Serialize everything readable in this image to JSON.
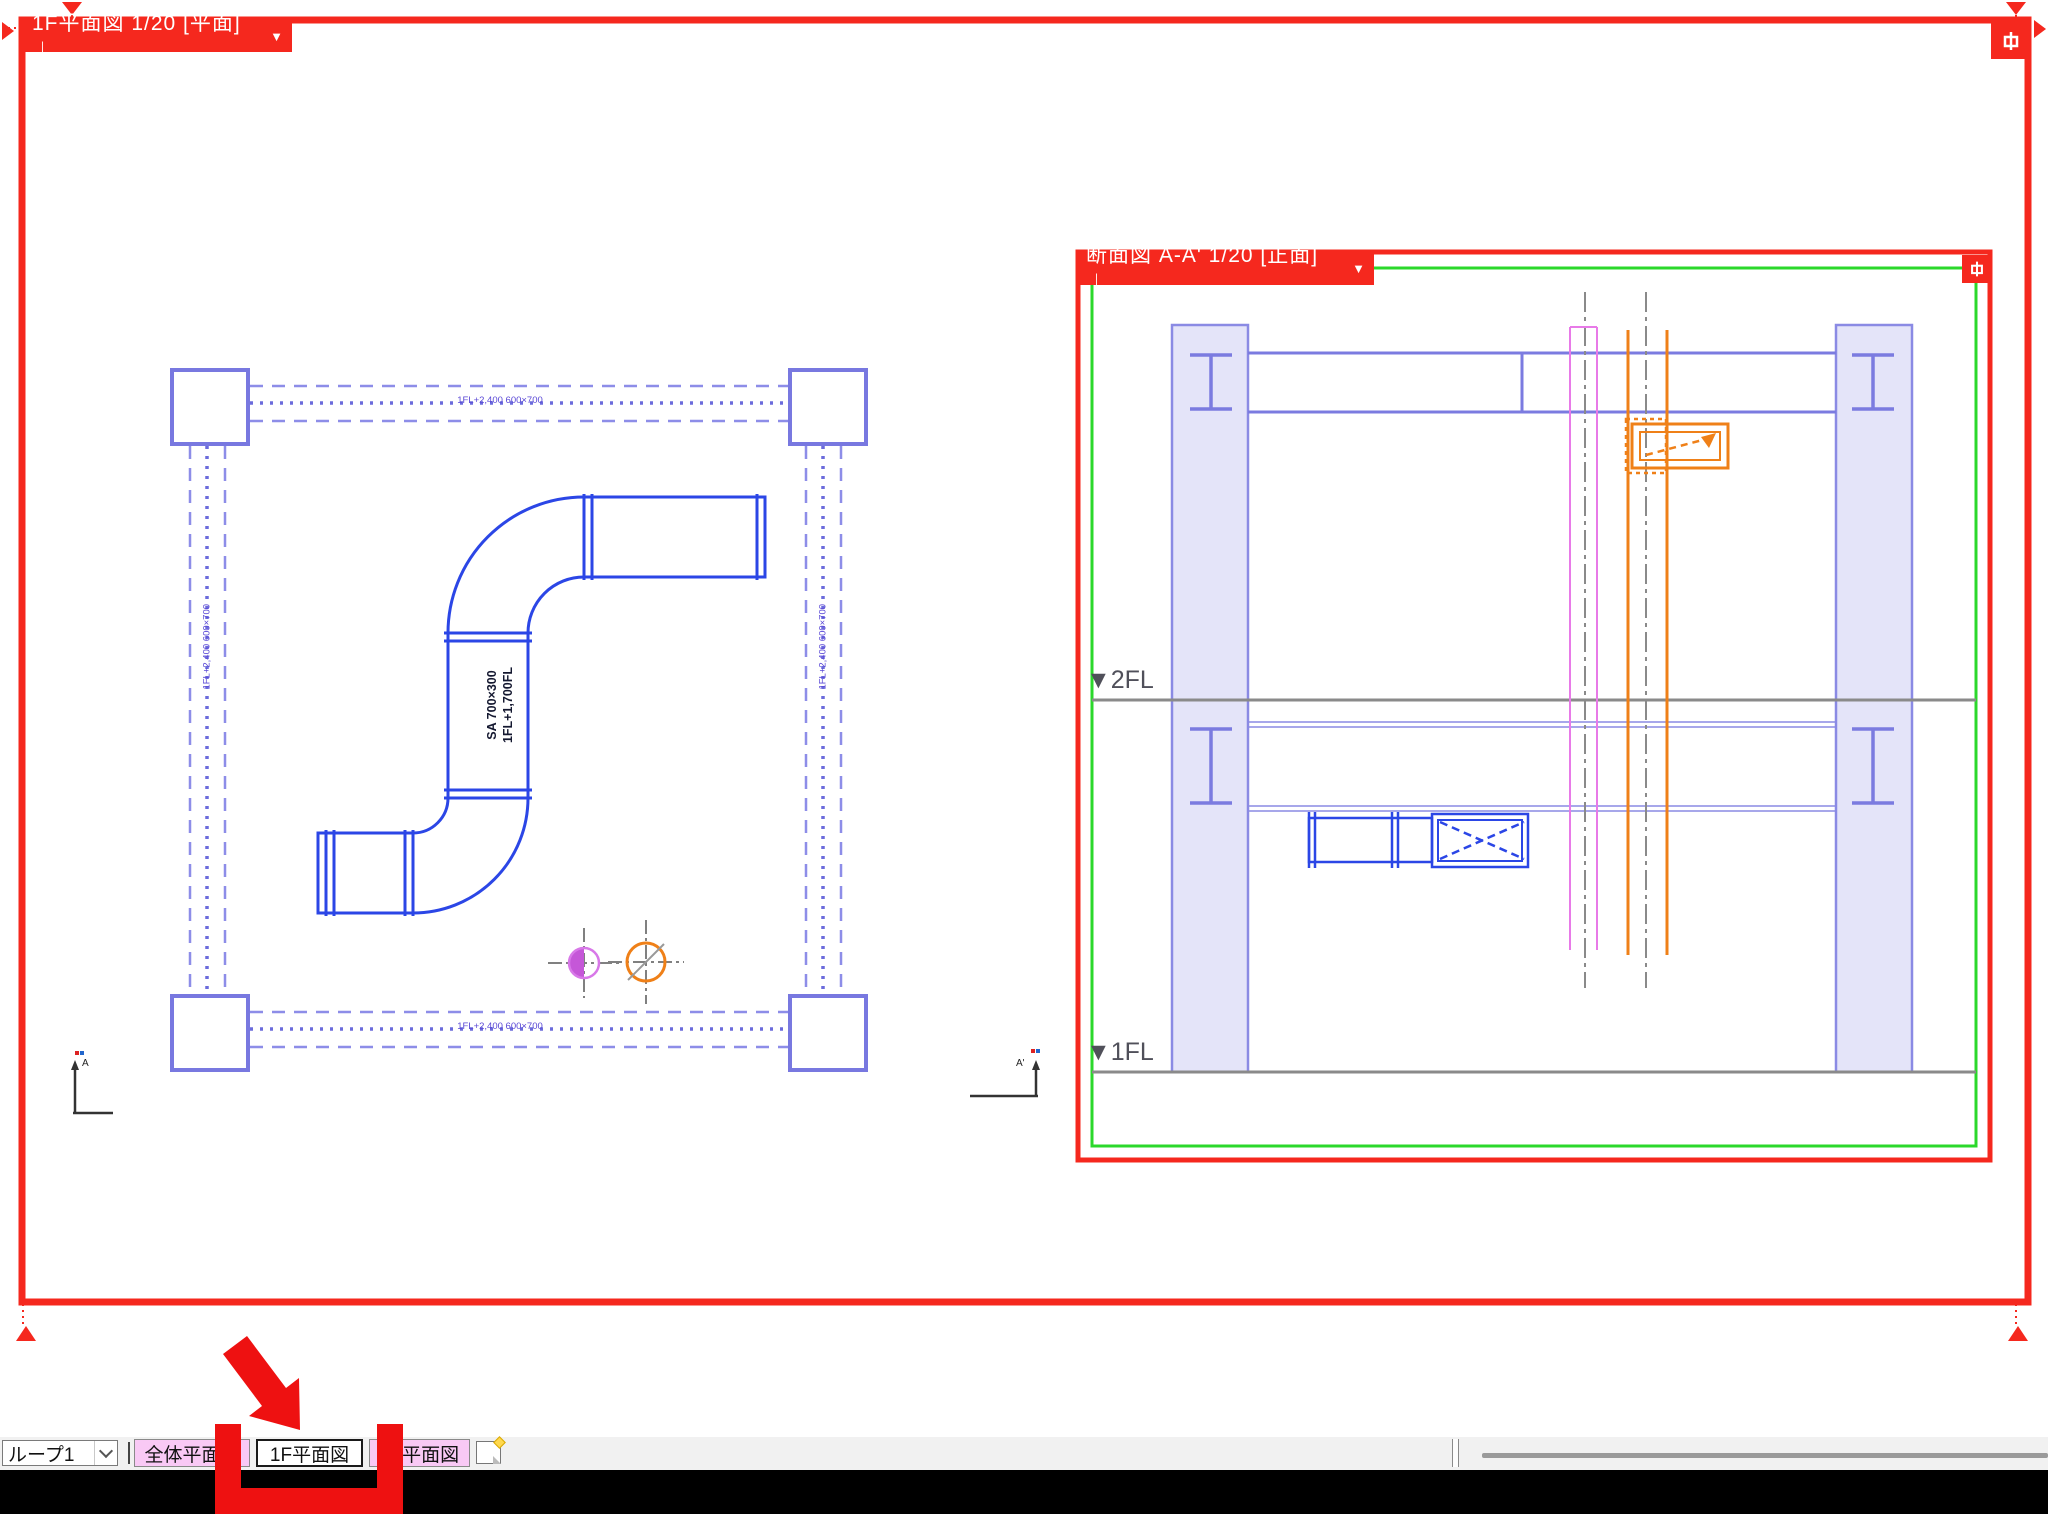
{
  "plan_view": {
    "title": "1F平面図 1/20 [平面]｜",
    "duct_label_l1": "SA 700×300",
    "duct_label_l2": "1FL+1,700FL",
    "beam_label": "1FL+2,400 600×700",
    "marker_left": "A",
    "marker_right": "A'"
  },
  "section_view": {
    "title": "断面図 A-A' 1/20 [正面]｜",
    "level_2f": "▼2FL",
    "level_1f": "▼1FL"
  },
  "tab_bar": {
    "group_selector_value": "ループ1",
    "tabs": [
      {
        "label": "全体平面図",
        "active": false
      },
      {
        "label": "1F平面図",
        "active": true
      },
      {
        "label": "2F平面図",
        "active": false
      }
    ]
  },
  "ui": {
    "dropdown_glyph": "▼"
  },
  "colors": {
    "selection_red": "#f5281e",
    "annotation_red": "#ee1111",
    "structure_purple": "#7b7be0",
    "duct_blue": "#2b46e6",
    "duct_magenta": "#e87ae8",
    "duct_orange": "#ef8018",
    "paper_green": "#2bd82b",
    "tab_pink": "#f9c9f5"
  }
}
